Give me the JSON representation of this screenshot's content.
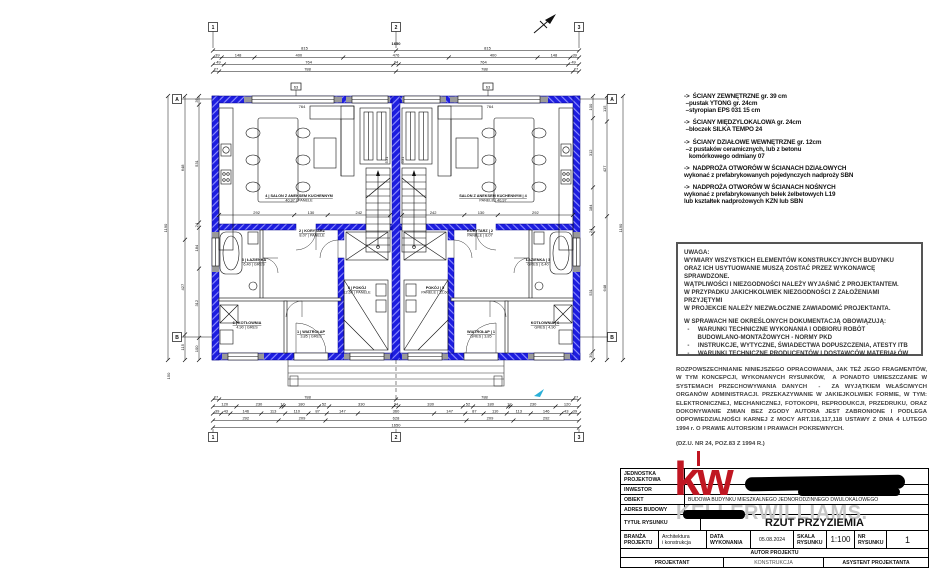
{
  "colors": {
    "wall_blue": "#1d1de0",
    "wall_hatch": "#8f8fff",
    "lintel_grey": "#9a9a9a",
    "kw_red": "#c01622",
    "kw_grey": "#c6c6c6",
    "redaction_black": "#000000",
    "line_black": "#111111",
    "marker_cyan": "#2ab0d8"
  },
  "notes": {
    "lines": [
      "->  ŚCIANY ZEWNĘTRZNE gr. 39 cm",
      " –pustak YTONG gr. 24cm",
      " –styropian EPS 031 15 cm",
      "",
      "->  ŚCIANY MIĘDZYLOKALOWA gr. 24cm",
      " –bloczek SILKA TEMPO 24",
      "",
      "->  ŚCIANY DZIAŁOWE WEWNĘTRZNE gr. 12cm",
      " –z pustaków ceramicznych, lub z betonu",
      "   komórkowego odmiany 07",
      "",
      "->  NADPROŻA OTWORÓW W ŚCIANACH DZIAŁOWYCH",
      "wykonać z prefabrykowanych pojedynczych nadproży SBN",
      "",
      "->  NADPROŻA OTWORÓW W ŚCIANACH NOŚNYCH",
      "wykonać z prefabrykowanych belek żelbetowych L19",
      "lub kształtek nadprożowych KZN lub SBN"
    ]
  },
  "uwaga": {
    "lines": [
      "UWAGA:",
      "WYMIARY WSZYSTKICH ELEMENTÓW KONSTRUKCYJNYCH BUDYNKU",
      "ORAZ ICH USYTUOWANIE MUSZĄ ZOSTAĆ PRZEZ WYKONAWCĘ SPRAWDZONE.",
      "WĄTPLIWOŚCI I NIEZGODNOŚCI NALEŻY WYJAŚNIĆ Z PROJEKTANTEM.",
      "W PRZYPADKU JAKICHKOLWIEK NIEZGODNOŚCI Z ZAŁOŻENIAMI PRZYJĘTYMI",
      "W PROJEKCIE NALEŻY NIEZWŁOCZNIE ZAWIADOMIĆ PROJEKTANTA.",
      "",
      "W SPRAWACH NIE OKREŚLONYCH DOKUMENTACJĄ OBOWIĄZUJĄ:",
      "  -     WARUNKI TECHNICZNE WYKONANIA I ODBIORU ROBÓT",
      "        BUDOWLANO-MONTAŻOWYCH - NORMY PKD",
      "  -     INSTRUKCJE, WYTYCZNE, ŚWIADECTWA DOPUSZCZENIA, ATESTY ITB",
      "  -     WARUNKI TECHNICZNE PRODUCENTÓW I DOSTAWCÓW MATERIAŁÓW"
    ]
  },
  "copyright": {
    "lines": [
      "ROZPOWSZECHNIANIE NINIEJSZEGO OPRACOWANIA, JAK TEŻ JEGO FRAGMENTÓW, W TYM KONCEPCJI, WYKONANYCH RYSUNKÓW,  A PONADTO UMIESZCZANIE W SYSTEMACH PRZECHOWYWANIA DANYCH  -  ZA WYJĄTKIEM WŁAŚCIWYCH ORGANÓW ADMINISTRACJI. PRZEKAZYWANIE W JAKIEJKOLWIEK FORMIE, W TYM: ELEKTRONICZNEJ, MECHANICZNEJ, FOTOKOPII, REPRODUKCJI, PRZEDRUKU, ORAZ DOKONYWANIE ZMIAN BEZ ZGODY AUTORA JEST ZABRONIONE I PODLEGA ODPOWIEDZIALNOŚCI KARNEJ Z MOCY ART.116,117,118 USTAWY Z DNIA 4 LUTEGO 1994 r. O PRAWIE AUTORSKIM I PRAWACH POKREWNYCH.",
      "(DZ.U. NR 24, POZ.83 Z 1994 R.)"
    ]
  },
  "title_block": {
    "jednostka_label": "JEDNOSTKA\nPROJEKTOWA",
    "inwestor_label": "INWESTOR",
    "obiekt_label": "OBIEKT",
    "obiekt_value": "BUDOWA BUDYNKU MIESZKALNEGO JEDNORODZINNEGO DWULOKALOWEGO",
    "adres_label": "ADRES BUDOWY",
    "tytul_label": "TYTUŁ RYSUNKU",
    "tytul_value": "RZUT PRZYZIEMIA",
    "branza_label": "BRANŻA\nPROJEKTU",
    "branza_value": "Architektura\ni konstrukcja",
    "data_label": "DATA\nWYKONANIA",
    "data_value": "05.08.2024",
    "skala_label": "SKALA\nRYSUNKU",
    "skala_value": "1:100",
    "nr_label": "NR\nRYSUNKU",
    "nr_value": "1",
    "autor_label": "AUTOR PROJEKTU",
    "projektant_label": "PROJEKTANT",
    "konstrukcja_label": "KONSTRUKCJA",
    "asystent_label": "ASYSTENT PROJEKTANTA",
    "logo_mark": "kw",
    "logo_brand": "KELLERWILLIAMS."
  },
  "plan": {
    "axes": {
      "cols": [
        "1",
        "2",
        "3"
      ],
      "rows": [
        "A",
        "B"
      ]
    },
    "rooms": [
      {
        "num": "1",
        "name": "WIATROŁAP",
        "area": "3,85",
        "floor": "GRES"
      },
      {
        "num": "2",
        "name": "KORYTARZ",
        "area": "8,07",
        "floor": "PANELE"
      },
      {
        "num": "3",
        "name": "ŁAZIENKA",
        "area": "6,40",
        "floor": "GRES"
      },
      {
        "num": "4",
        "name": "SALON Z ANEKSEM KUCHENNYM",
        "area": "40,97",
        "floor": "PANELE"
      },
      {
        "num": "5",
        "name": "POKÓJ",
        "area": "12,60",
        "floor": "PANELE"
      },
      {
        "num": "6",
        "name": "KOTŁOWNIA",
        "area": "4,90",
        "floor": "GRES"
      }
    ],
    "dims": {
      "top_total": "1650",
      "top": [
        [
          "815",
          "815"
        ],
        [
          "39",
          "148",
          "400",
          "476",
          "400",
          "148",
          "39"
        ],
        [
          "49",
          "764",
          "24",
          "764",
          "49"
        ],
        [
          "27",
          "788",
          "788",
          "27"
        ]
      ],
      "bottom": [
        [
          "27",
          "788",
          "788",
          "27"
        ],
        [
          "120",
          "230",
          "12",
          "180",
          "52",
          "330",
          "24",
          "330",
          "52",
          "180",
          "12",
          "230",
          "120"
        ],
        [
          "39",
          "43",
          "146",
          "113",
          "110",
          "87",
          "147",
          "360",
          "147",
          "87",
          "110",
          "113",
          "146",
          "43",
          "39"
        ],
        [
          "292",
          "209",
          "628",
          "209",
          "292"
        ],
        [
          "1650"
        ]
      ],
      "left": [
        [
          "1190"
        ],
        [
          "648",
          "427",
          "115"
        ],
        [
          "39",
          "531",
          "24",
          "184",
          "312",
          "100"
        ]
      ],
      "inner_salon": [
        "292",
        "130",
        "242"
      ],
      "lintel": "764",
      "stair_side": "531",
      "window_marker": "63",
      "below_b": "150"
    }
  }
}
